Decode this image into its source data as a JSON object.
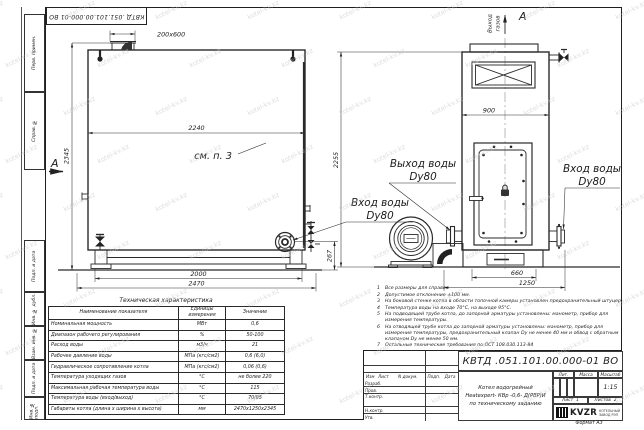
{
  "meta": {
    "stamp_top": "КВТД .051.101.00.000-01 ВО",
    "format_label": "Формат А3",
    "watermark": "kotel-kv.kz"
  },
  "frame": {
    "left_labels": [
      "Перв. примен.",
      "Справ. №",
      "Подп. и дата",
      "Инв. № дубл.",
      "Взам. инв. №",
      "Подп. и дата",
      "Инв. № подл."
    ]
  },
  "front_view": {
    "section_label": "А",
    "see_note": "см. п. 3",
    "dim_stub": "200x600",
    "dim_width_top": "2240",
    "dim_height": "2345",
    "dim_legs": "2000",
    "dim_total_width": "2470",
    "dim_flange_height": "267",
    "label_inlet_1": "Вход воды",
    "label_inlet_2": "Dy80"
  },
  "side_view": {
    "section_label": "А",
    "gas_outlet_1": "Выход",
    "gas_outlet_2": "газов",
    "dim_width": "900",
    "dim_height": "2255",
    "dim_base": "660",
    "dim_total": "1250",
    "label_outlet_1": "Выход воды",
    "label_outlet_2": "Dy80",
    "label_inlet_1": "Вход воды",
    "label_inlet_2": "Dy80"
  },
  "tech_table": {
    "title": "Техническая характеристика",
    "headers": [
      "Наименование показателя",
      "Единицы измерения",
      "Значение"
    ],
    "rows": [
      [
        "Номинальная мощность",
        "МВт",
        "0,6"
      ],
      [
        "Диапазон рабочего регулирования",
        "%",
        "50-100"
      ],
      [
        "Расход воды",
        "м3/ч",
        "21"
      ],
      [
        "Рабочее давление воды",
        "МПа (кгс/см2)",
        "0,6 (6,0)"
      ],
      [
        "Гидравлическое сопротивление котла",
        "МПа (кгс/см2)",
        "0,06 (0,6)"
      ],
      [
        "Температура уходящих газов",
        "°С",
        "не более 220"
      ],
      [
        "Максимальная рабочая температура воды",
        "°С",
        "115"
      ],
      [
        "Температура воды (вход/выход)",
        "°С",
        "70/95"
      ],
      [
        "Габариты котла (длина х ширина х высота)",
        "мм",
        "2470х1250х2345"
      ]
    ]
  },
  "notes": [
    {
      "n": "1",
      "text": "Все размеры для справок"
    },
    {
      "n": "2",
      "text": "Допустимое отклонение ±100 мм."
    },
    {
      "n": "3",
      "text": "На боковой стенке котла в области топочной камеры установлен предохранительный штуцер"
    },
    {
      "n": "4",
      "text": "Температура воды на входе 70°С, на выходе 95°С."
    },
    {
      "n": "5",
      "text": "На подводящей трубе котла, до запорной арматуры установлены: манометр, прибор для измерения температуры."
    },
    {
      "n": "6",
      "text": "На отводящей трубе котла до запорной арматуры установлены: манометр, прибор для измерения температуры, предохранительный клапан Dу не менее 40 мм и обвод с обратным клапаном Dу не менее 50 мм."
    },
    {
      "n": "7",
      "text": "Остальные технические требования по ОСТ 108.030.113-84"
    }
  ],
  "title_block": {
    "designation": "КВТД .051.101.00.000-01 ВО",
    "name_line1": "Котел водогрейный",
    "name_line2": "Heatexpert- КВр -0,6- Д(РВР)И",
    "name_line3": "по техническому заданию",
    "col_headers": {
      "izm": "Изм",
      "list": "Лист",
      "doc": "N докум.",
      "podp": "Подп.",
      "data": "Дата"
    },
    "rows": [
      "Разраб.",
      "Пров.",
      "Т.контр.",
      "",
      "Н.контр.",
      "Утв."
    ],
    "lit_label": "Лит.",
    "mass_label": "Масса",
    "scale_label": "Масштаб",
    "scale_value": "1:15",
    "sheet_label": "Лист",
    "sheet_value": "1",
    "sheets_label": "Листов",
    "sheets_value": "2",
    "company_logo": "KVZR",
    "company_line1": "КОТЕЛЬНЫЙ",
    "company_line2": "ЗАВОД РЭП"
  }
}
